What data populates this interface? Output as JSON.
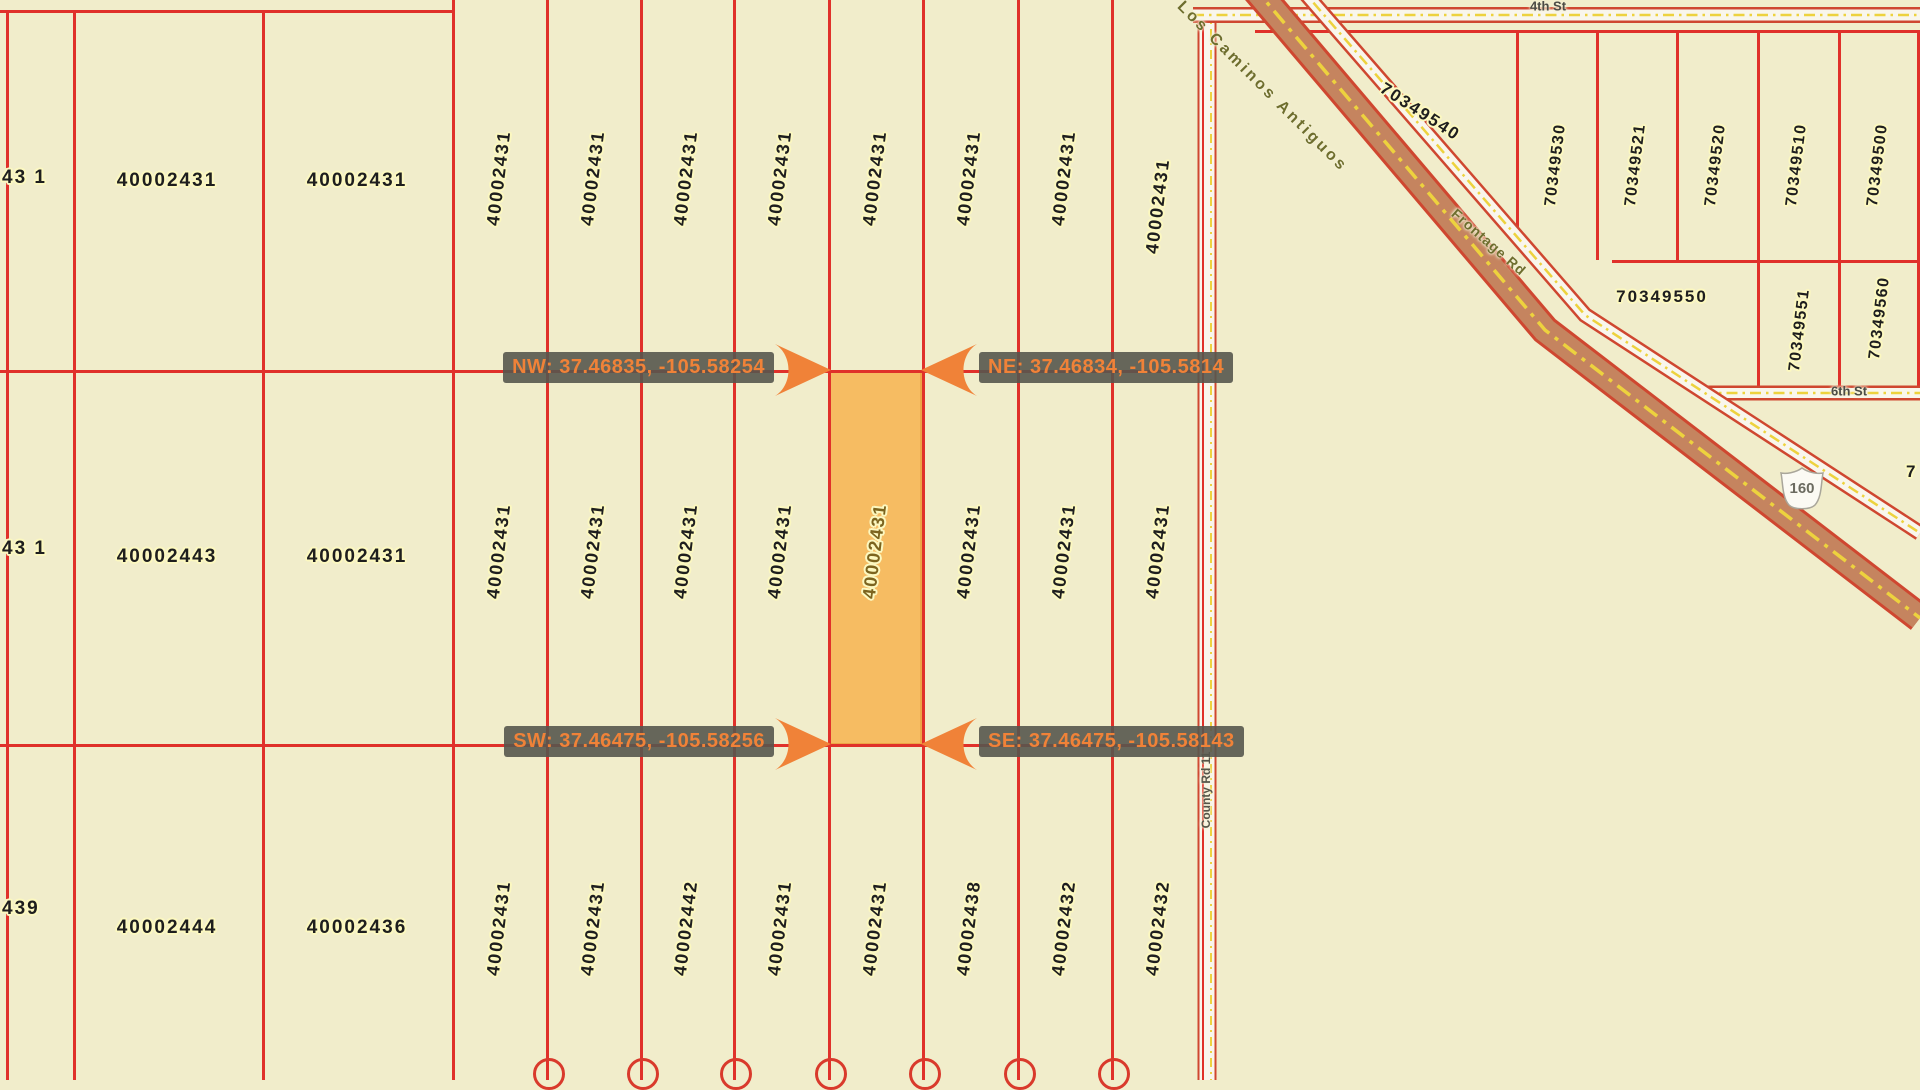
{
  "map_labels": {
    "corner": {
      "nw": "NW: 37.46835, -105.58254",
      "ne": "NE: 37.46834, -105.5814",
      "sw": "SW: 37.46475, -105.58256",
      "se": "SE: 37.46475, -105.58143"
    },
    "streets": {
      "top": "4th St",
      "right": "6th St",
      "county_road": "County Rd 11",
      "scenic_byway": "Los Caminos Antiguos",
      "frontage": "Frontage Rd",
      "highway_shield": "160"
    },
    "left_block": {
      "row1": {
        "edge": "43 1",
        "c1": "40002431",
        "c2": "40002431"
      },
      "row2": {
        "edge": "43 1",
        "c1": "40002443",
        "c2": "40002431"
      },
      "row3": {
        "edge": "439",
        "c1": "40002444",
        "c2": "40002436"
      }
    },
    "strips": {
      "top": [
        "40002431",
        "40002431",
        "40002431",
        "40002431",
        "40002431",
        "40002431",
        "40002431",
        "40002431"
      ],
      "middle": [
        "40002431",
        "40002431",
        "40002431",
        "40002431",
        "40002431",
        "40002431",
        "40002431",
        "40002431"
      ],
      "bottom": [
        "40002431",
        "40002431",
        "40002442",
        "40002431",
        "40002431",
        "40002438",
        "40002432",
        "40002432"
      ]
    },
    "highlighted": {
      "row": "middle",
      "index": 4,
      "parcel": "40002431"
    },
    "ne_block": {
      "triangle": "70349540",
      "strips": [
        "70349530",
        "70349521",
        "70349520",
        "70349510",
        "70349500"
      ],
      "below": "70349550",
      "below_strips": [
        "70349551",
        "70349560"
      ],
      "edge_partial": "7"
    },
    "colors": {
      "background": "#f1edcb",
      "parcel_line": "#e0312a",
      "highlight_fill": "#f6bc62",
      "accent_orange": "#f08238",
      "label_box": "#56564e"
    }
  }
}
